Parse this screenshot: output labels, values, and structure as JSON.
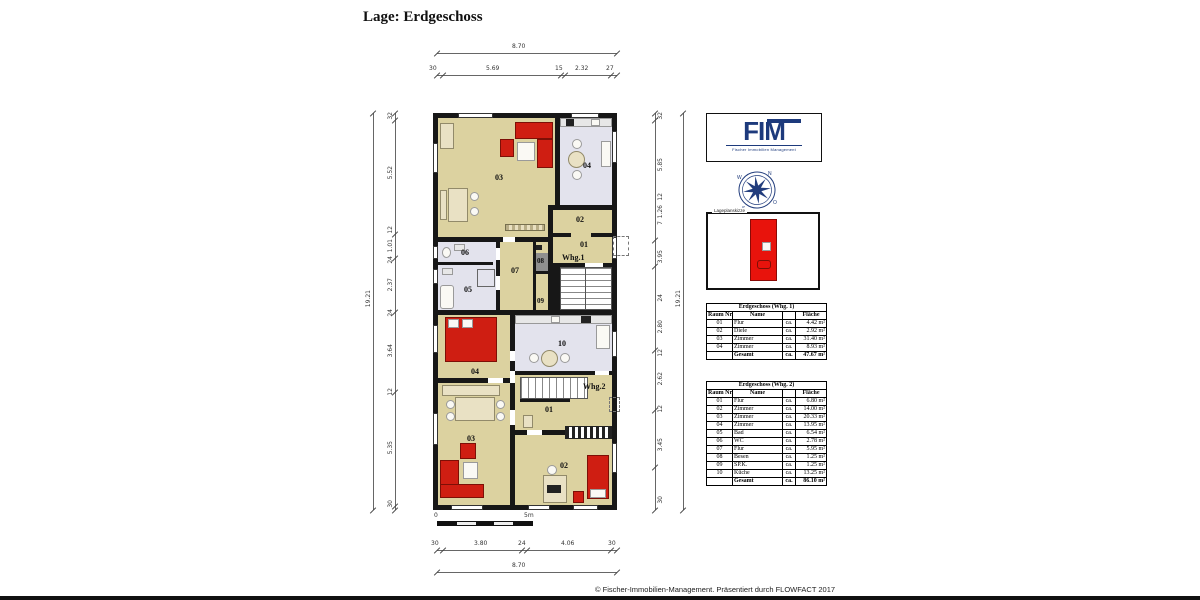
{
  "page_title": "Lage: Erdgeschoss",
  "footer": "© Fischer-Immobilien-Management. Präsentiert durch FLOWFACT 2017",
  "logo": {
    "name": "FIM",
    "subtitle": "Fischer Immobilien Management"
  },
  "site_plan": {
    "label": "Lageplanskizze"
  },
  "scale_bar": {
    "zero": "0",
    "five": "5m"
  },
  "colors": {
    "wall": "#171717",
    "floor_wood": "#dcd2a0",
    "floor_tile": "#e3e3ed",
    "furniture_red": "#cf1e12",
    "logo_blue": "#1d3a7c",
    "site_red": "#e8130c"
  },
  "dimensions": {
    "top": {
      "overall": "8.70",
      "segments": [
        "30",
        "5.69",
        "15",
        "2.32",
        "27"
      ]
    },
    "bottom": {
      "overall": "8.70",
      "segments": [
        "30",
        "3.80",
        "24",
        "4.06",
        "30"
      ]
    },
    "left": {
      "overall": "19.21",
      "segments": [
        "32",
        "5.52",
        "12",
        "1.01",
        "24",
        "2.37",
        "24",
        "3.64",
        "12",
        "5.35",
        "30"
      ]
    },
    "right": {
      "overall": "19.21",
      "segments": [
        "32",
        "5.85",
        "12",
        "1.26",
        "7",
        "3.95",
        "24",
        "2.80",
        "12",
        "2.62",
        "12",
        "3.45",
        "30"
      ]
    }
  },
  "plan": {
    "whg1": {
      "unit": "Whg.1",
      "r01": "01",
      "r02": "02",
      "r03": "03",
      "r04": "04",
      "r05": "05",
      "r06": "06",
      "r07": "07",
      "r08": "08",
      "r09": "09"
    },
    "whg2": {
      "unit": "Whg.2",
      "r01": "01",
      "r02": "02",
      "r03": "03",
      "r04": "04",
      "r10": "10"
    }
  },
  "tables": {
    "whg1": {
      "title": "Erdgeschoss (Whg. 1)",
      "headers": [
        "Raum Nr.",
        "Name",
        "",
        "Fläche"
      ],
      "rows": [
        {
          "nr": "01",
          "name": "Flur",
          "ca": "ca.",
          "area": "4.42 m²"
        },
        {
          "nr": "02",
          "name": "Diele",
          "ca": "ca.",
          "area": "2.92 m²"
        },
        {
          "nr": "03",
          "name": "Zimmer",
          "ca": "ca.",
          "area": "31.40 m²"
        },
        {
          "nr": "04",
          "name": "Zimmer",
          "ca": "ca.",
          "area": "8.93 m²"
        }
      ],
      "total": {
        "label": "Gesamt",
        "ca": "ca.",
        "area": "47.67 m²"
      }
    },
    "whg2": {
      "title": "Erdgeschoss (Whg. 2)",
      "headers": [
        "Raum Nr.",
        "Name",
        "",
        "Fläche"
      ],
      "rows": [
        {
          "nr": "01",
          "name": "Flur",
          "ca": "ca.",
          "area": "6.80 m²"
        },
        {
          "nr": "02",
          "name": "Zimmer",
          "ca": "ca.",
          "area": "14.00 m²"
        },
        {
          "nr": "03",
          "name": "Zimmer",
          "ca": "ca.",
          "area": "20.33 m²"
        },
        {
          "nr": "04",
          "name": "Zimmer",
          "ca": "ca.",
          "area": "13.95 m²"
        },
        {
          "nr": "05",
          "name": "Bad",
          "ca": "ca.",
          "area": "6.54 m²"
        },
        {
          "nr": "06",
          "name": "WC",
          "ca": "ca.",
          "area": "2.78 m²"
        },
        {
          "nr": "07",
          "name": "Flur",
          "ca": "ca.",
          "area": "5.95 m²"
        },
        {
          "nr": "08",
          "name": "Besen",
          "ca": "ca.",
          "area": "1.25 m²"
        },
        {
          "nr": "09",
          "name": "SP.K.",
          "ca": "ca.",
          "area": "1.25 m²"
        },
        {
          "nr": "10",
          "name": "Küche",
          "ca": "ca.",
          "area": "13.25 m²"
        }
      ],
      "total": {
        "label": "Gesamt",
        "ca": "ca.",
        "area": "86.10 m²"
      }
    }
  }
}
